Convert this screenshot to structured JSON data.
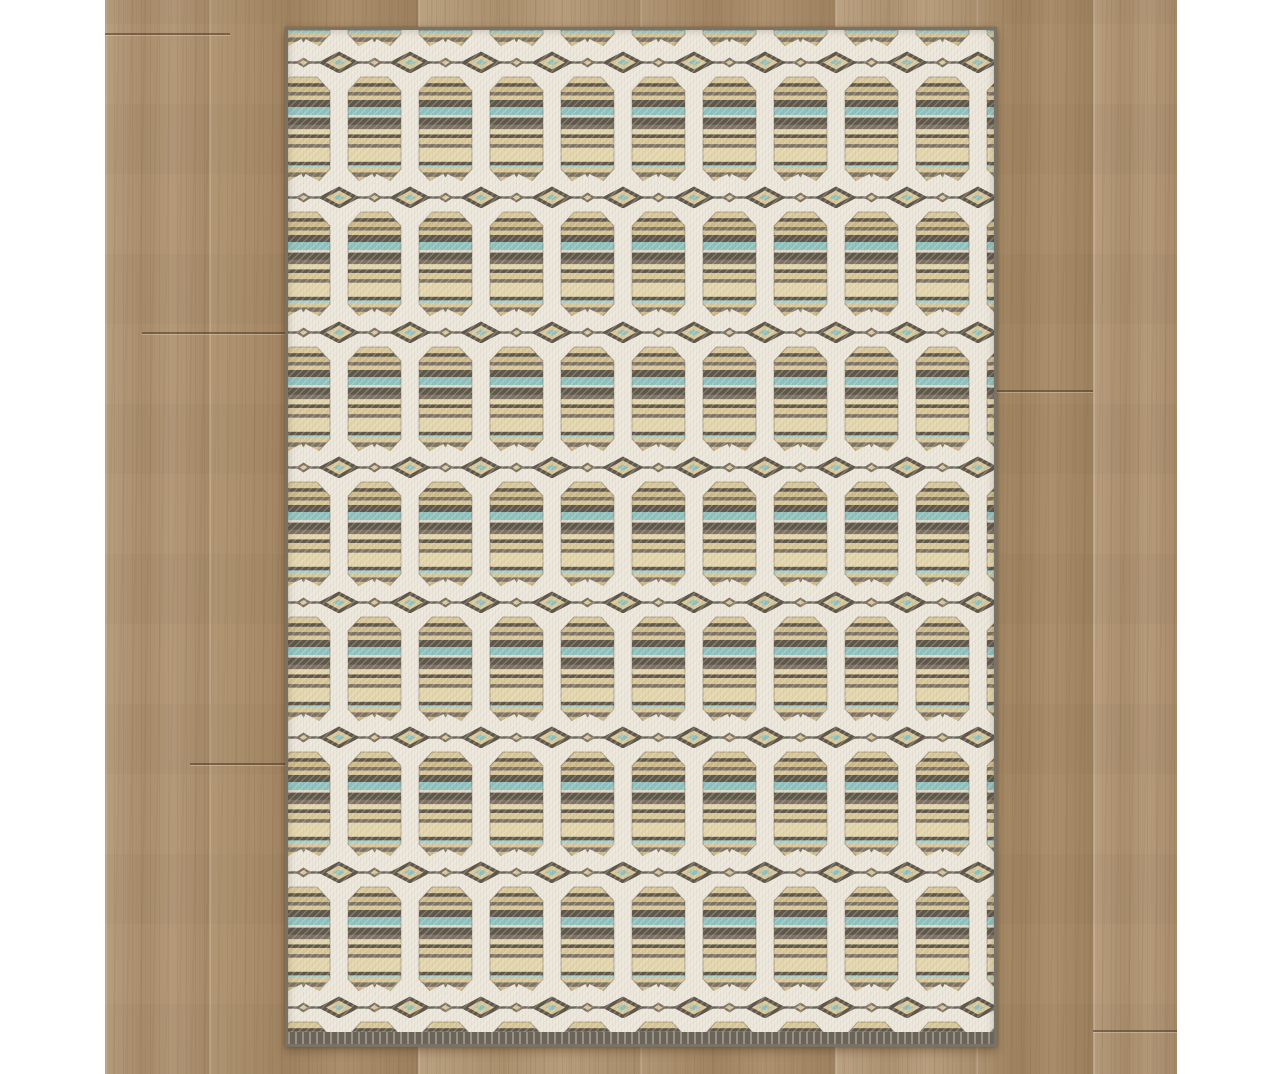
{
  "scene": {
    "subject": "striped geometric trellis area rug photographed flat on a light brown wood plank floor with white side margins",
    "background_color": "#ffffff",
    "floor": {
      "left": 105,
      "right": 1177,
      "base_color": "#ae916e",
      "seam_color": "rgba(94,70,46,0.40)",
      "planks": [
        {
          "x": 105,
          "w": 104,
          "tone": "#b09472"
        },
        {
          "x": 209,
          "w": 209,
          "tone": "#a98c67"
        },
        {
          "x": 418,
          "w": 222,
          "tone": "#b69b77"
        },
        {
          "x": 640,
          "w": 195,
          "tone": "#ab8e6a"
        },
        {
          "x": 835,
          "w": 141,
          "tone": "#b89d7a"
        },
        {
          "x": 976,
          "w": 117,
          "tone": "#a78a65"
        },
        {
          "x": 1093,
          "w": 84,
          "tone": "#b19573"
        }
      ],
      "joints": [
        {
          "x": 105,
          "w": 125,
          "y": 33
        },
        {
          "x": 142,
          "w": 188,
          "y": 332
        },
        {
          "x": 190,
          "w": 100,
          "y": 763
        },
        {
          "x": 997,
          "w": 96,
          "y": 390
        },
        {
          "x": 1093,
          "w": 84,
          "y": 1030
        }
      ]
    },
    "rug": {
      "x": 285,
      "y": 27,
      "width": 712,
      "height": 1020,
      "edge_color": "#7a7365",
      "selvage_color": "#6b6459",
      "colors": {
        "cream": "#ebe6d9",
        "cream2": "#e0d9c7",
        "beige": "#d8c697",
        "tan": "#cdb987",
        "tan_light": "#e3d5ab",
        "brown": "#7d7263",
        "dark": "#5f574a",
        "dark2": "#4e473e",
        "teal": "#8fc2bf",
        "teal_soft": "#a9cfca"
      },
      "pattern": {
        "tile_width": 71,
        "tile_height": 135,
        "offset": {
          "x": -20,
          "y": -92
        },
        "cell": {
          "x": 9,
          "w": 53,
          "top": 4,
          "bottom": 110,
          "chamfer": 14,
          "design_height": 120
        },
        "stripes": [
          {
            "y": 0,
            "h": 7,
            "c": "beige"
          },
          {
            "y": 7,
            "h": 4,
            "c": "dark"
          },
          {
            "y": 11,
            "h": 6,
            "c": "tan"
          },
          {
            "y": 17,
            "h": 4,
            "c": "brown"
          },
          {
            "y": 21,
            "h": 5,
            "c": "beige"
          },
          {
            "y": 26,
            "h": 8,
            "c": "dark"
          },
          {
            "y": 34,
            "h": 9,
            "c": "teal"
          },
          {
            "y": 43,
            "h": 3,
            "c": "cream2"
          },
          {
            "y": 46,
            "h": 8,
            "c": "dark"
          },
          {
            "y": 54,
            "h": 5,
            "c": "brown"
          },
          {
            "y": 59,
            "h": 6,
            "c": "tan_light"
          },
          {
            "y": 65,
            "h": 4,
            "c": "dark"
          },
          {
            "y": 69,
            "h": 7,
            "c": "beige"
          },
          {
            "y": 76,
            "h": 4,
            "c": "brown"
          },
          {
            "y": 80,
            "h": 16,
            "c": "tan_light"
          },
          {
            "y": 96,
            "h": 4,
            "c": "dark"
          },
          {
            "y": 100,
            "h": 3,
            "c": "teal_soft"
          },
          {
            "y": 103,
            "h": 5,
            "c": "beige"
          },
          {
            "y": 108,
            "h": 5,
            "c": "brown"
          },
          {
            "y": 113,
            "h": 7,
            "c": "tan"
          }
        ],
        "band": {
          "center_y": 124.5,
          "lattice_stroke_width": 9,
          "diamond": {
            "rx1": 21,
            "ry1": 11,
            "rx2": 13,
            "ry2": 7,
            "rx3": 6,
            "ry3": 3
          },
          "ornament": {
            "rx1": 8,
            "ry1": 5,
            "rx2": 4,
            "ry2": 2.5
          }
        }
      }
    }
  }
}
